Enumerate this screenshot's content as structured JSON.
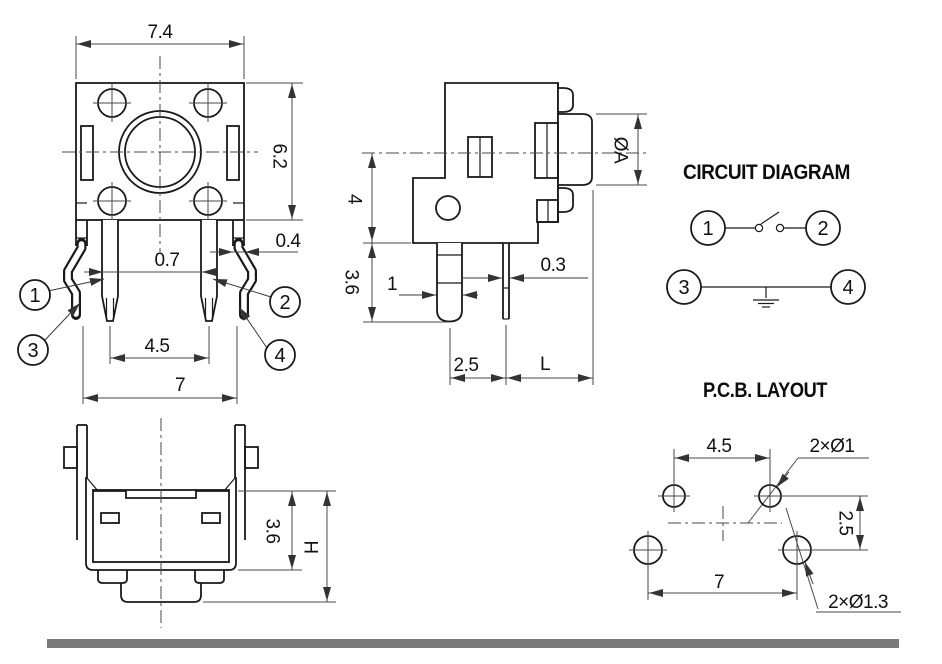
{
  "front_view": {
    "dim_body_width": "7.4",
    "dim_body_height": "6.2",
    "dim_pin_width": "0.7",
    "dim_bent_pin_width": "0.4",
    "dim_inner_pin_pitch": "4.5",
    "dim_outer_pin_pitch": "7",
    "balloon_1": "1",
    "balloon_2": "2",
    "balloon_3": "3",
    "balloon_4": "4"
  },
  "side_view": {
    "dim_body_depth": "4",
    "dim_pin_length": "3.6",
    "dim_flat_pin_width": "1",
    "dim_thin_pin_width": "0.3",
    "dim_pin_offset": "2.5",
    "dim_stem_length": "L",
    "dim_button_diameter": "ØA"
  },
  "circuit_diagram": {
    "title": "CIRCUIT DIAGRAM",
    "terminal_1": "1",
    "terminal_2": "2",
    "terminal_3": "3",
    "terminal_4": "4"
  },
  "pcb_layout": {
    "title": "P.C.B. LAYOUT",
    "dim_top_hole_pitch": "4.5",
    "label_small_holes": "2×Ø1",
    "dim_row_pitch": "2.5",
    "dim_bottom_hole_pitch": "7",
    "label_large_holes": "2×Ø1.3"
  },
  "bottom_view": {
    "dim_body_height": "3.6",
    "dim_total_height": "H"
  }
}
